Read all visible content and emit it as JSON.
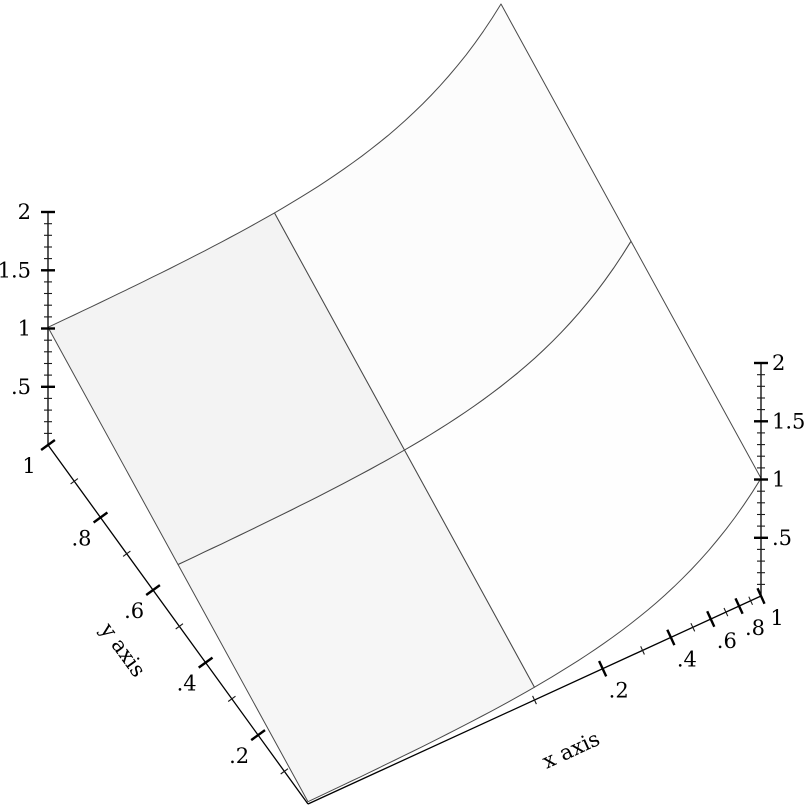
{
  "figure": {
    "width": 812,
    "height": 812,
    "background": "#ffffff"
  },
  "chart_data": {
    "type": "surface3d",
    "title": "",
    "xlabel": "x axis",
    "ylabel": "y axis",
    "zlabel": "",
    "x_scale": "log",
    "y_scale": "linear",
    "z_scale": "linear",
    "x_range": [
      0.01,
      1
    ],
    "y_range": [
      0.01,
      1
    ],
    "z_range": [
      0,
      2
    ],
    "surface_function": "x + y",
    "grid_x": [
      0.01,
      0.1,
      1
    ],
    "grid_y": [
      0.01,
      0.505,
      1
    ],
    "z_values_rows_y_cols_x": [
      [
        0.02,
        0.11,
        1.01
      ],
      [
        0.515,
        0.605,
        1.505
      ],
      [
        1.01,
        1.1,
        2.0
      ]
    ],
    "x_axis": {
      "label": "x axis",
      "major_ticks": [
        0.2,
        0.4,
        0.6,
        0.8,
        1
      ],
      "major_tick_labels": [
        ".2",
        ".4",
        ".6",
        ".8",
        "1"
      ],
      "minor_ticks": [
        0.1,
        0.3,
        0.5,
        0.7,
        0.9
      ]
    },
    "y_axis": {
      "label": "y axis",
      "major_ticks": [
        0.2,
        0.4,
        0.6,
        0.8,
        1
      ],
      "major_tick_labels": [
        ".2",
        ".4",
        ".6",
        ".8",
        "1"
      ],
      "minor_ticks": [
        0.1,
        0.3,
        0.5,
        0.7,
        0.9
      ]
    },
    "z_axis": {
      "major_ticks": [
        0.5,
        1,
        1.5,
        2
      ],
      "major_tick_labels": [
        ".5",
        "1",
        "1.5",
        "2"
      ],
      "minor_tick_step": 0.1,
      "drawn_on": [
        "far-left-edge",
        "far-right-edge"
      ]
    },
    "legend": "none",
    "grid": "surface-sample-grid-only",
    "colors": {
      "quad_left_top": "#f3f3f3",
      "quad_left_bottom": "#f6f6f6",
      "quad_right_top": "#fcfcfc",
      "quad_right_bottom": "#fefefe",
      "surface_line": "#4a4a4a",
      "axis_line": "#000000",
      "tick_major": "#000000",
      "tick_minor": "#1a1a1a",
      "label_text": "#000000"
    },
    "projection": {
      "origin_px": [
        308,
        804
      ],
      "eU_px": [
        453,
        -208
      ],
      "eV_px": [
        -260,
        -359
      ],
      "eW_px": [
        0,
        -233
      ]
    }
  }
}
